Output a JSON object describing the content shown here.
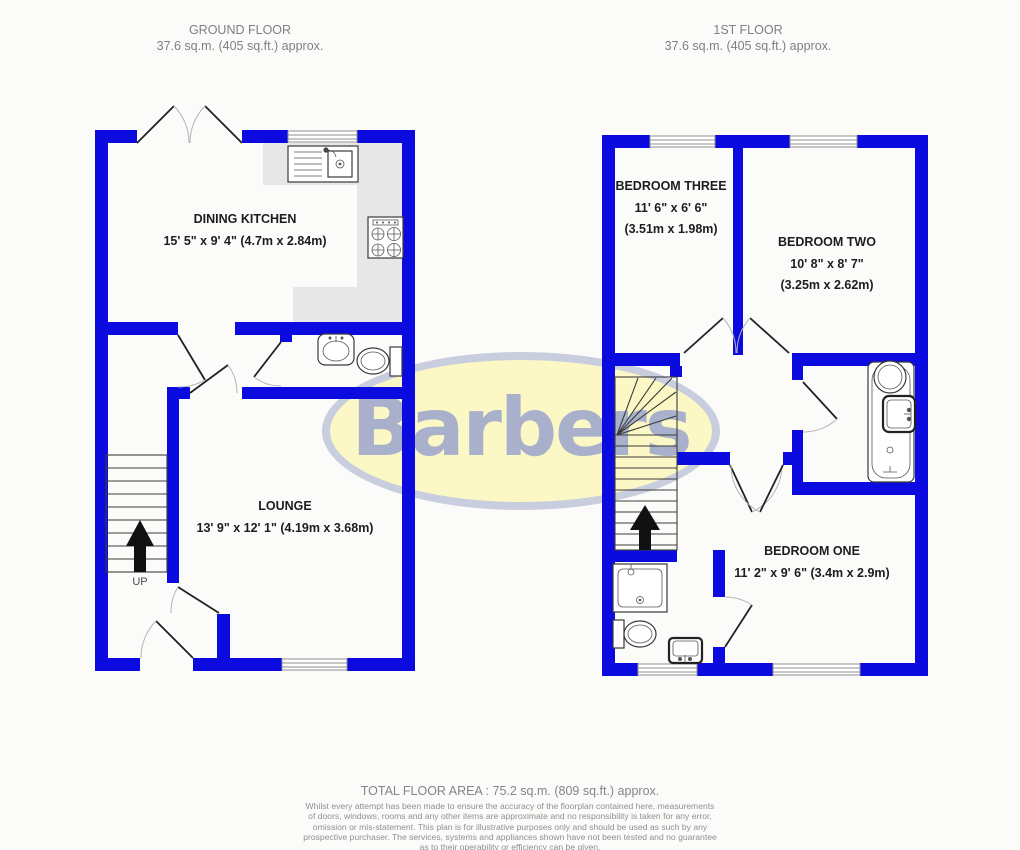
{
  "floors": [
    {
      "title": "GROUND FLOOR",
      "area": "37.6 sq.m. (405 sq.ft.) approx."
    },
    {
      "title": "1ST FLOOR",
      "area": "37.6 sq.m. (405 sq.ft.) approx."
    }
  ],
  "rooms": {
    "dining_kitchen": {
      "name": "DINING KITCHEN",
      "dims": "15' 5\" x 9' 4\" (4.7m x 2.84m)"
    },
    "lounge": {
      "name": "LOUNGE",
      "dims": "13' 9\" x 12' 1\" (4.19m x 3.68m)"
    },
    "bedroom_three": {
      "name": "BEDROOM THREE",
      "dims_imperial": "11' 6\" x 6' 6\"",
      "dims_metric": "(3.51m x 1.98m)"
    },
    "bedroom_two": {
      "name": "BEDROOM TWO",
      "dims_imperial": "10' 8\" x 8' 7\"",
      "dims_metric": "(3.25m x 2.62m)"
    },
    "bedroom_one": {
      "name": "BEDROOM ONE",
      "dims": "11' 2\" x 9' 6\" (3.4m x 2.9m)"
    }
  },
  "stairs": {
    "up_label": "UP"
  },
  "logo": {
    "text": "Barbers",
    "fill": "#fbf8c5",
    "stroke": "#c9cede",
    "text_color": "#a9b0cc"
  },
  "footer": {
    "total_area": "TOTAL FLOOR AREA : 75.2 sq.m. (809 sq.ft.) approx.",
    "disclaimer_lines": [
      "Whilst every attempt has been made to ensure the accuracy of the floorplan contained here, measurements",
      "of doors, windows, rooms and any other items are approximate and no responsibility is taken for any error,",
      "omission or mis-statement. This plan is for illustrative purposes only and should be used as such by any",
      "prospective purchaser. The services, systems and appliances shown have not been tested and no guarantee",
      "as to their operability or efficiency can be given."
    ],
    "credit": "Made with Metropix ©2024"
  },
  "colors": {
    "wall": "#0b0be0",
    "counter": "#e7e7e7",
    "background": "#fbfbf9"
  }
}
